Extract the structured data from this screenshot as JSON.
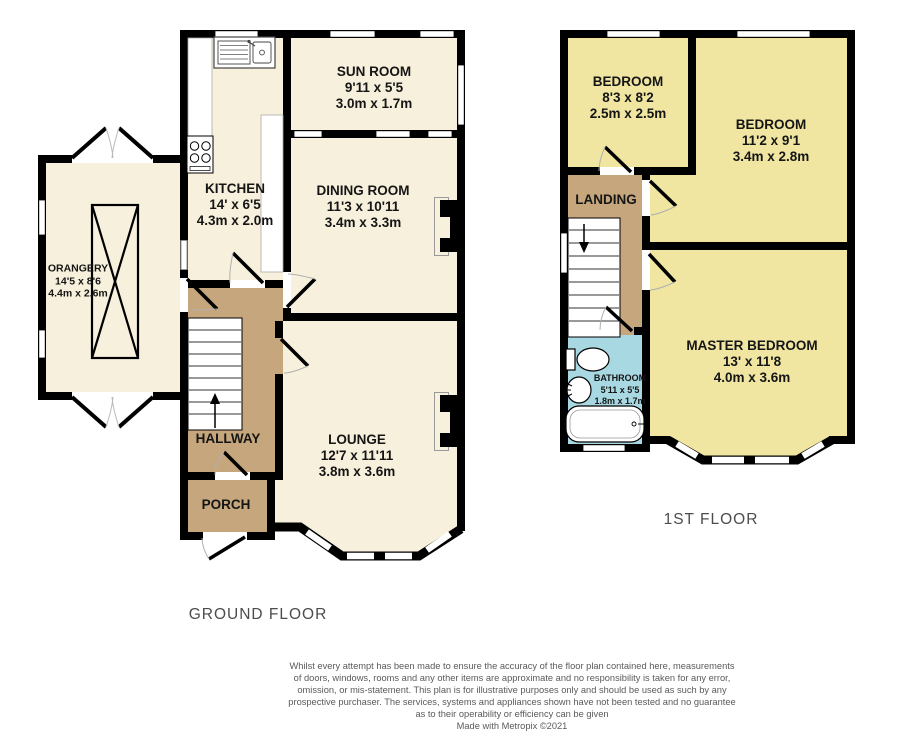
{
  "ground_floor": {
    "label": "GROUND FLOOR",
    "rooms": {
      "sun_room": {
        "name": "SUN ROOM",
        "imperial": "9'11 x 5'5",
        "metric": "3.0m x 1.7m"
      },
      "kitchen": {
        "name": "KITCHEN",
        "imperial": "14' x 6'5",
        "metric": "4.3m x 2.0m"
      },
      "dining_room": {
        "name": "DINING ROOM",
        "imperial": "11'3 x 10'11",
        "metric": "3.4m x 3.3m"
      },
      "orangery": {
        "name": "ORANGERY",
        "imperial": "14'5 x 8'6",
        "metric": "4.4m x 2.6m"
      },
      "hallway": {
        "name": "HALLWAY"
      },
      "porch": {
        "name": "PORCH"
      },
      "lounge": {
        "name": "LOUNGE",
        "imperial": "12'7 x 11'11",
        "metric": "3.8m x 3.6m"
      }
    }
  },
  "first_floor": {
    "label": "1ST FLOOR",
    "rooms": {
      "bedroom_2": {
        "name": "BEDROOM",
        "imperial": "8'3 x 8'2",
        "metric": "2.5m x 2.5m"
      },
      "bedroom_3": {
        "name": "BEDROOM",
        "imperial": "11'2 x 9'1",
        "metric": "3.4m x 2.8m"
      },
      "landing": {
        "name": "LANDING"
      },
      "bathroom": {
        "name": "BATHROOM",
        "imperial": "5'11 x 5'5",
        "metric": "1.8m x 1.7m"
      },
      "master_bedroom": {
        "name": "MASTER BEDROOM",
        "imperial": "13' x 11'8",
        "metric": "4.0m x 3.6m"
      }
    }
  },
  "footer": {
    "disclaimer_lines": [
      "Whilst every attempt has been made to ensure the accuracy of the floor plan contained here, measurements",
      "of doors, windows, rooms and any other items are approximate and no responsibility is taken for any error,",
      "omission, or mis-statement. This plan is for illustrative purposes only and should be used as such by any",
      "prospective purchaser. The services, systems and appliances shown have not been tested and no guarantee",
      "as to their operability or efficiency can be given"
    ],
    "credit": "Made with Metropix ©2021"
  },
  "colors": {
    "room_fill_ground": "#F7F0DC",
    "room_fill_first": "#F0E6A2",
    "circulation_fill": "#C6A67C",
    "bathroom_fill": "#A8D8E2",
    "wall": "#000000"
  }
}
